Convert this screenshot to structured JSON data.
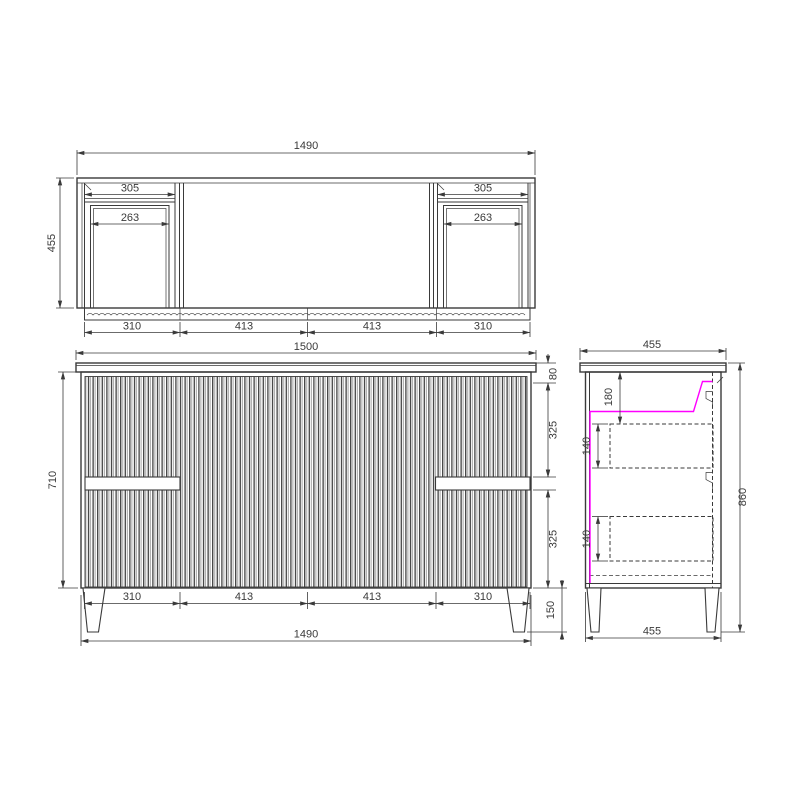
{
  "colors": {
    "line": "#3a3a3a",
    "text": "#3a3a3a",
    "highlight_magenta": "#ff00ff",
    "background": "#ffffff"
  },
  "top_view": {
    "overall_width": "1490",
    "depth": "455",
    "left_cutout_width": "305",
    "left_cutout_inner_width": "263",
    "right_cutout_width": "305",
    "right_cutout_inner_width": "263",
    "front_segments": [
      "310",
      "413",
      "413",
      "310"
    ]
  },
  "front_view": {
    "benchtop_width": "1500",
    "carcass_height": "710",
    "top_offset": "80",
    "upper_drawer_height": "325",
    "lower_drawer_height": "325",
    "leg_height": "150",
    "segments": [
      "310",
      "413",
      "413",
      "310"
    ],
    "overall_width": "1490"
  },
  "side_view": {
    "top_depth": "455",
    "bottom_depth": "455",
    "overall_height": "860",
    "top_clearance": "180",
    "upper_drawer_depth": "140",
    "lower_drawer_depth": "140"
  }
}
